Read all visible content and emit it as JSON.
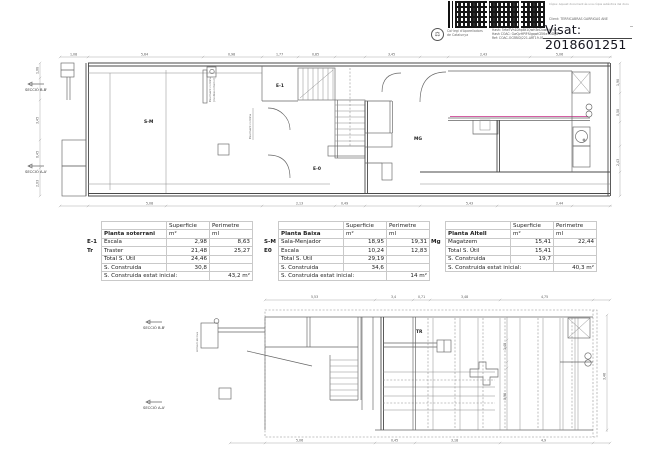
{
  "stamp": {
    "copy_line": "Còpia: Aquest document és una còpia autèntica del document original",
    "org_name_line1": "Col·legi d'Aparelladors",
    "org_name_line2": "de Catalunya",
    "hash_line1": "Hash: 5rfwTVh1DhpBt1QwH3nDuwQbjjYf=",
    "hash_line2": "Hash COAC: GwQvHPlFfUgqwlCEKteTDDgB=",
    "hash_line3": "Ref: COAC-OCEBID/221-ART19-01",
    "client_line": "Client: TERRICABRAS GARRIGAS ANE",
    "visat_label": "Visat: 2018601251"
  },
  "plans": {
    "top": {
      "rooms": {
        "sala_menjador": "S-M",
        "escala_upper": "E-1",
        "escala_lower": "E-0",
        "magatzem": "MG"
      },
      "sections": {
        "bb": "SECCIÓ B-B'",
        "aa": "SECCIÓ A-A'"
      },
      "annotations": {
        "note1_l1": "Paviment continu",
        "note1_l2": "(mobles interior)",
        "note2": "Paviment continu"
      },
      "dims": {
        "top": [
          "1,08",
          "5,64",
          "0,98",
          "1,77",
          "0,85",
          "3,45",
          "2,43",
          "5,06"
        ],
        "bottom": [
          "5,08",
          "2,13",
          "0,49",
          "5,43",
          "2,44"
        ],
        "left": [
          "1,08",
          "3,45",
          "0,45",
          "2,03"
        ],
        "right": [
          "1,98",
          "0,58",
          "2,43"
        ]
      }
    },
    "bottom": {
      "rooms": {
        "tr": "TR"
      },
      "sections": {
        "bb": "SECCIÓ B-B'",
        "aa": "SECCIÓ A-A'"
      },
      "annotations": {
        "note1": "Armari alcova"
      },
      "dims": {
        "top": [
          "5,53",
          "3,4",
          "0,71",
          "3,48",
          "4,75"
        ],
        "bottom": [
          "5,06",
          "0,45",
          "3,18",
          "4,9"
        ],
        "right": [
          "3,46"
        ],
        "inner": [
          "1,45",
          "0,98"
        ]
      }
    }
  },
  "tables": [
    {
      "name": "table-planta-soterrani",
      "col_headers": [
        "Superficie",
        "Perimetre"
      ],
      "title": "Planta soterrani",
      "units": [
        "m²",
        "ml"
      ],
      "rows": [
        {
          "code": "E-1",
          "label": "Escala",
          "sup": "2,98",
          "per": "8,63"
        },
        {
          "code": "Tr",
          "label": "Traster",
          "sup": "21,48",
          "per": "25,27"
        },
        {
          "code": "",
          "label": "Total S. Útil",
          "sup": "24,46",
          "per": "",
          "cls": "total"
        },
        {
          "code": "",
          "label": "S. Construida",
          "sup": "30,8",
          "per": ""
        },
        {
          "code": "",
          "label": "S. Construida estat inicial:",
          "span": true,
          "per": "43,2 m²",
          "cls": "final"
        }
      ]
    },
    {
      "name": "table-planta-baixa",
      "col_headers": [
        "Superficie",
        "Perimetre"
      ],
      "title": "Planta Baixa",
      "units": [
        "m²",
        "ml"
      ],
      "rows": [
        {
          "code": "S-M",
          "label": "Sala-Menjador",
          "sup": "18,95",
          "per": "19,31"
        },
        {
          "code": "E0",
          "label": "Escala",
          "sup": "10,24",
          "per": "12,83"
        },
        {
          "code": "",
          "label": "Total S. Útil",
          "sup": "29,19",
          "per": "",
          "cls": "total"
        },
        {
          "code": "",
          "label": "S. Construida",
          "sup": "34,6",
          "per": ""
        },
        {
          "code": "",
          "label": "S. Construida estat inicial:",
          "span": true,
          "per": "14 m²",
          "cls": "final"
        }
      ]
    },
    {
      "name": "table-planta-altell",
      "col_headers": [
        "Superficie",
        "Perimetre"
      ],
      "title": "Planta Altell",
      "units": [
        "m²",
        "ml"
      ],
      "rows": [
        {
          "code": "Mg",
          "label": "Magatzem",
          "sup": "15,41",
          "per": "22,44"
        },
        {
          "code": "",
          "label": "Total S. Útil",
          "sup": "15,41",
          "per": "",
          "cls": "total"
        },
        {
          "code": "",
          "label": "S. Construida",
          "sup": "19,7",
          "per": ""
        },
        {
          "code": "",
          "label": "S. Construida estat inicial:",
          "span": true,
          "per": "40,3 m²",
          "cls": "final"
        }
      ]
    }
  ]
}
